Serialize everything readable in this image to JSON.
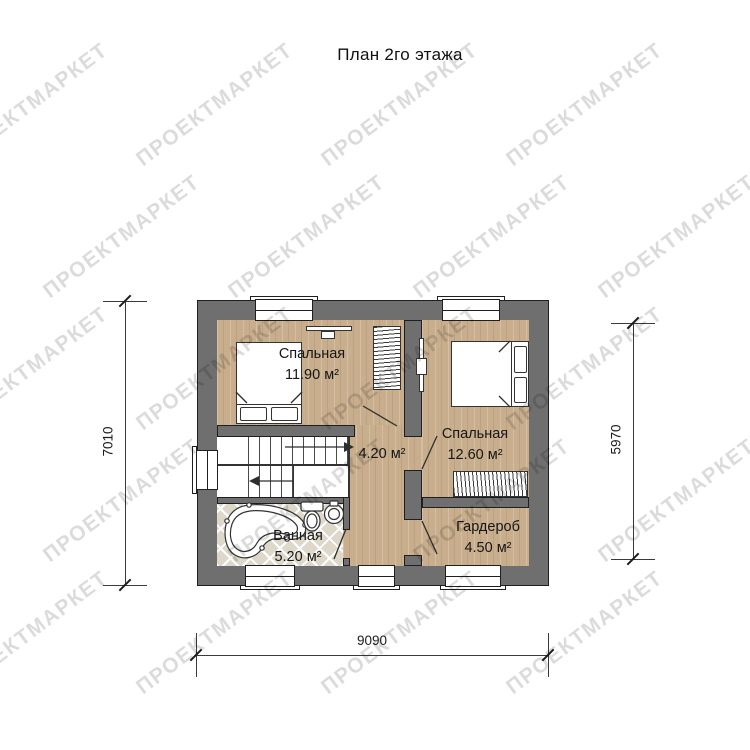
{
  "title": "План 2го этажа",
  "watermark": {
    "text": "ПРОЕКТМАРКЕТ"
  },
  "rooms": [
    {
      "name": "Спальная",
      "area": "11.90 м²"
    },
    {
      "name": "Спальная",
      "area": "12.60 м²"
    },
    {
      "name": "",
      "area": "4.20 м²"
    },
    {
      "name": "Ванная",
      "area": "5.20 м²"
    },
    {
      "name": "Гардероб",
      "area": "4.50 м²"
    }
  ],
  "dimensions": {
    "left": "7010",
    "right": "5970",
    "bottom": "9090"
  },
  "colors": {
    "wall": "#6f6f6f",
    "wood": "#c9ae8d",
    "tile": "#ddd8ca",
    "outline": "#1f1f1f",
    "watermark": "rgba(0,0,0,0.14)"
  }
}
